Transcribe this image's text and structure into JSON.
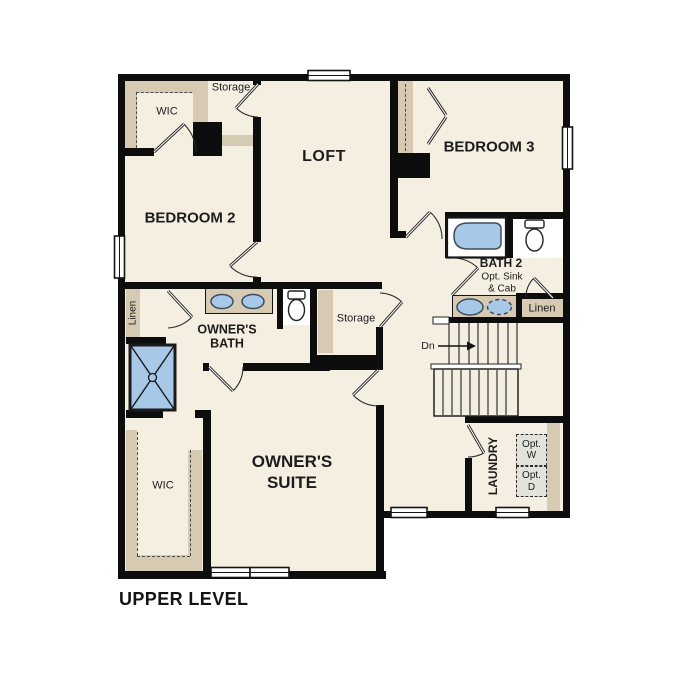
{
  "title": "UPPER LEVEL",
  "colors": {
    "floor_cream": "#f5efe1",
    "closet_tan": "#d6cab2",
    "fixture_blue": "#a8c8e8",
    "wall_black": "#0d0d0d",
    "optional_gray": "#e2e3db"
  },
  "rooms": {
    "wic_upper": {
      "label": "WIC"
    },
    "storage_top": {
      "label": "Storage"
    },
    "loft": {
      "label": "LOFT"
    },
    "bedroom2": {
      "label": "BEDROOM 2"
    },
    "bedroom3": {
      "label": "BEDROOM 3"
    },
    "bath2": {
      "label": "BATH 2",
      "note": "Opt. Sink\n& Cab"
    },
    "linen_hall": {
      "label": "Linen"
    },
    "linen_bath2": {
      "label": "Linen"
    },
    "owners_bath": {
      "label": "OWNER'S\nBATH"
    },
    "storage_mid": {
      "label": "Storage"
    },
    "owners_suite": {
      "label": "OWNER'S\nSUITE"
    },
    "suite_wic": {
      "label": "WIC"
    },
    "laundry": {
      "label": "LAUNDRY",
      "opt_washer": "Opt.\nW",
      "opt_dryer": "Opt.\nD"
    }
  },
  "stairs": {
    "down_label": "Dn"
  }
}
